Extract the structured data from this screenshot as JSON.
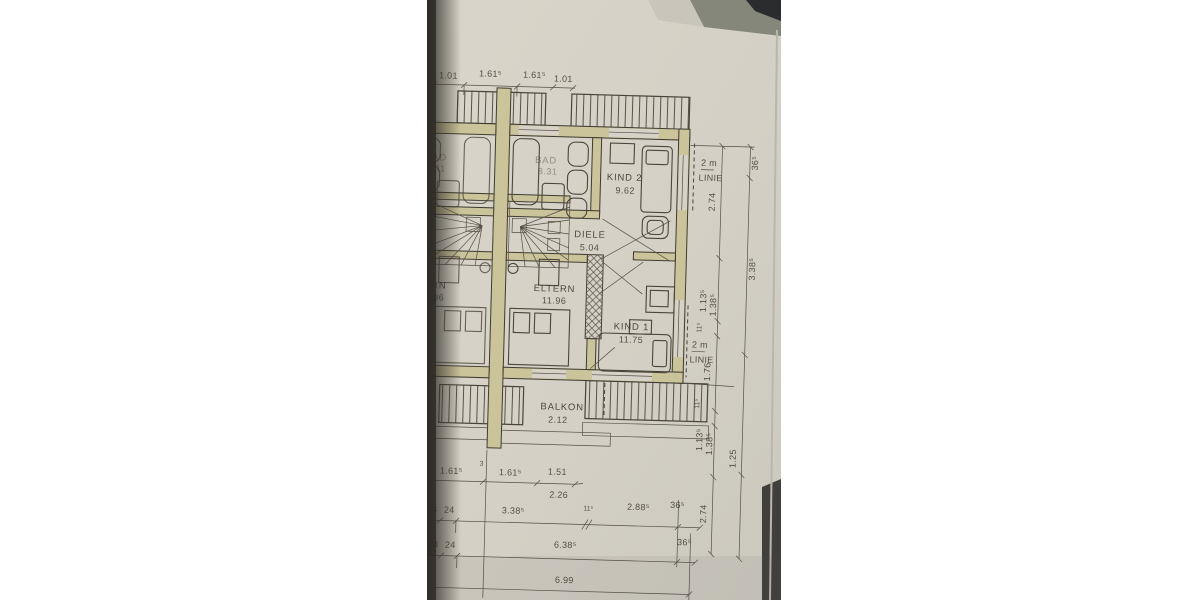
{
  "photo": {
    "description": "photo of architectural floor plan on paper",
    "rooms": {
      "bad": {
        "name": "BAD",
        "area": "8.31"
      },
      "kind2": {
        "name": "KIND 2",
        "area": "9.62"
      },
      "diele": {
        "name": "DIELE",
        "area": "5.04"
      },
      "eltern": {
        "name": "ELTERN",
        "area": "11.96"
      },
      "kind1": {
        "name": "KIND 1",
        "area": "11.75"
      },
      "balkon": {
        "name": "BALKON",
        "area": "2.12"
      },
      "bad_left": {
        "name": "BAD",
        "area": "8.31"
      },
      "eltern_left": {
        "name": "ELTERN",
        "area": "11.96"
      }
    },
    "annotations": {
      "linie_top_1": "2 m",
      "linie_top_2": "LINIE",
      "linie_bot_1": "2 m",
      "linie_bot_2": "LINIE"
    },
    "dims": {
      "top": [
        "1.01",
        "1.61⁵",
        "1.61⁵",
        "1.01"
      ],
      "right": [
        "36⁵",
        "2.74",
        "3.38⁵",
        "1.13⁵",
        "1.38⁵",
        "11⁵",
        "1.76",
        "11⁵",
        "1.13⁵",
        "1.38⁵",
        "1.25",
        "2.74"
      ],
      "bottom_row1": [
        "1.61⁵",
        "3",
        "1.61⁵",
        "1.51",
        "2.26"
      ],
      "bottom_row2": [
        "24",
        "24",
        "3.38⁵",
        "11⁵",
        "2.88⁵",
        "36⁵"
      ],
      "bottom_row3": [
        "24",
        "24",
        "6.38⁵",
        "36⁵"
      ],
      "bottom_row4": [
        "6.99"
      ]
    },
    "colors": {
      "paper": "#d6d2c7",
      "wall_fill": "#cbc39a",
      "ink": "#3c382e",
      "shadow": "#2d2a26",
      "table_top": "#85877b",
      "dark_object": "#2b2c2e"
    }
  }
}
